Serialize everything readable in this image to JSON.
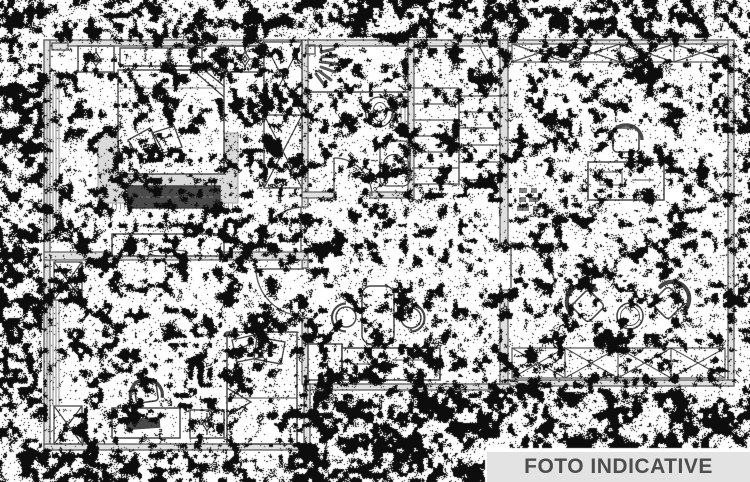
{
  "image": {
    "kind": "black-and-white architectural floor plan, heavily dithered scan",
    "width": 750,
    "height": 482
  },
  "watermark": {
    "label": "FOTO INDICATIVE"
  },
  "colors": {
    "paper": "#ffffff",
    "ink": "#474747",
    "wall_fill": "#e0e0e0",
    "wall_edge": "#4f4f4f",
    "carpet": "#e3e3e3",
    "dark_furniture": "#4a4a4a",
    "banner_bg": "#e3e3e3",
    "banner_text": "#4d4d4d",
    "noise": "#0d0d0d"
  },
  "plan": {
    "rooms": [
      {
        "id": "bedroom-1",
        "position": "top-left",
        "furniture": [
          "double-bed",
          "decorative-pillows",
          "nightstand-lamp-left",
          "nightstand-lamp-right",
          "headboard-units",
          "rug-with-fringe",
          "storage-bench",
          "tv-cabinet",
          "wardrobe-2x",
          "radiator-strip"
        ]
      },
      {
        "id": "bathroom",
        "position": "top-center",
        "furniture": [
          "shower-spray",
          "toilet",
          "washbasin",
          "door-arc"
        ]
      },
      {
        "id": "staircase",
        "position": "top-center-right",
        "furniture": [
          "steps-left-flight",
          "steps-right-flight",
          "landing-diagonal"
        ]
      },
      {
        "id": "living-room",
        "position": "right",
        "furniture": [
          "wardrobe-x-band-top",
          "desk",
          "office-chair",
          "armchair-left",
          "armchair-right",
          "round-table",
          "railing-x-band-bottom",
          "door-arc"
        ]
      },
      {
        "id": "bedroom-2",
        "position": "bottom-left",
        "furniture": [
          "single-bed",
          "pillows",
          "office-chair",
          "desk-with-laptop",
          "nightstand-lamp",
          "column-x-top",
          "column-x-bottom",
          "radiator-strip",
          "door-arc"
        ]
      },
      {
        "id": "kitchen-hall",
        "position": "bottom-center",
        "furniture": [
          "island-table",
          "stool-left",
          "stool-right",
          "appliance-box",
          "counter",
          "door-arc-to-living"
        ]
      }
    ]
  }
}
